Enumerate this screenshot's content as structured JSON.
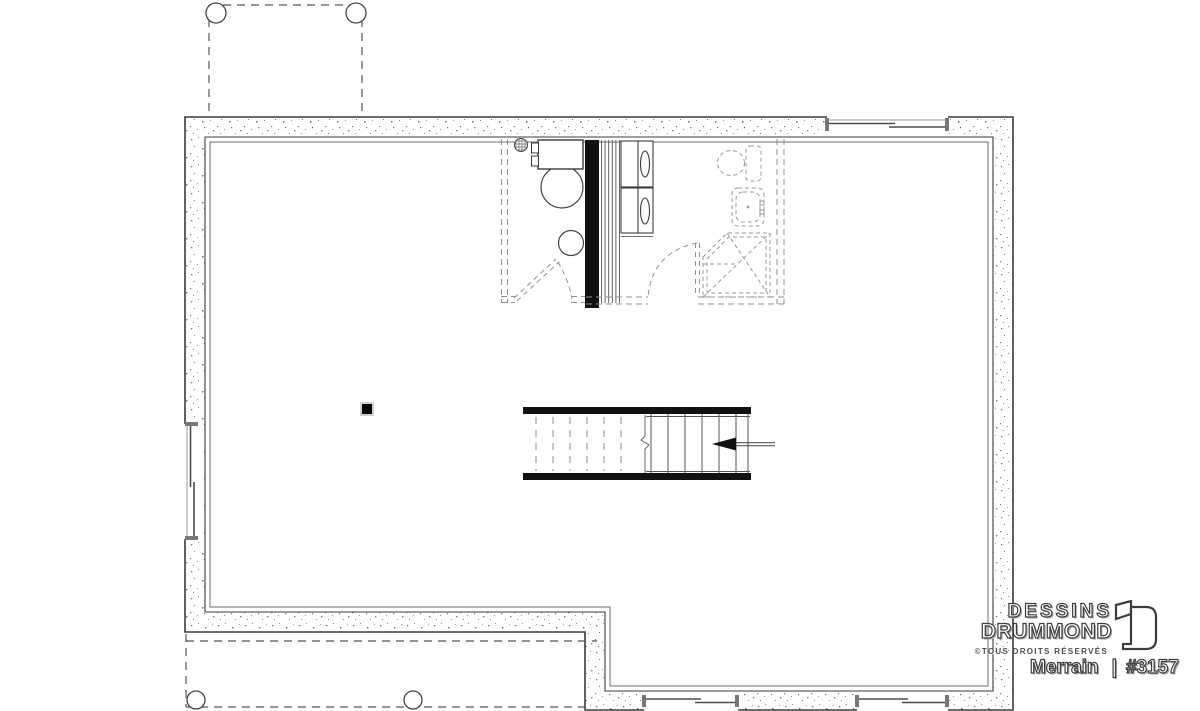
{
  "branding": {
    "studio_line1": "DESSINS",
    "studio_line2": "DRUMMOND",
    "rights": "©TOUS DROITS RÉSERVÉS",
    "plan_name": "Merrain",
    "separator": "|",
    "plan_number": "#3157"
  },
  "drawing": {
    "type": "basement floor plan",
    "colors": {
      "wall_outline": "#3b3b3b",
      "concrete_speckle": "#777777",
      "hidden_dashed": "#8f8f8f",
      "solid_black": "#111111",
      "background": "#ffffff",
      "logo_outline": "#3d3d3d"
    },
    "symbols": [
      "porch-post",
      "foundation-wall",
      "slider-window",
      "floor-drain",
      "furnace",
      "water-heater",
      "washer",
      "dryer",
      "toilet",
      "bathroom-sink",
      "corner-shower",
      "staircase",
      "direction-arrow",
      "structural-post",
      "door-swing"
    ]
  }
}
